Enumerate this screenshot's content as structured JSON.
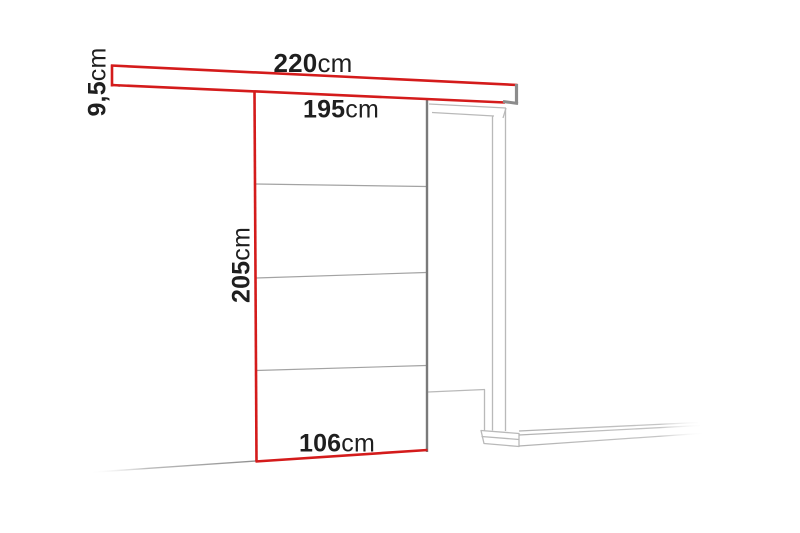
{
  "colors": {
    "highlight_red": "#d41b1b",
    "door_edge_gray": "#7a7a7a",
    "frame_gray": "#b9b9b9",
    "divider_gray": "#a3a3a3",
    "text": "#1f1f1f",
    "background": "#ffffff"
  },
  "diagram": {
    "labels": {
      "rail_length": {
        "value": "220",
        "unit": "cm"
      },
      "rail_height": {
        "value": "9,5",
        "unit": "cm"
      },
      "top_width": {
        "value": "195",
        "unit": "cm"
      },
      "door_height": {
        "value": "205",
        "unit": "cm"
      },
      "door_width": {
        "value": "106",
        "unit": "cm"
      }
    }
  }
}
